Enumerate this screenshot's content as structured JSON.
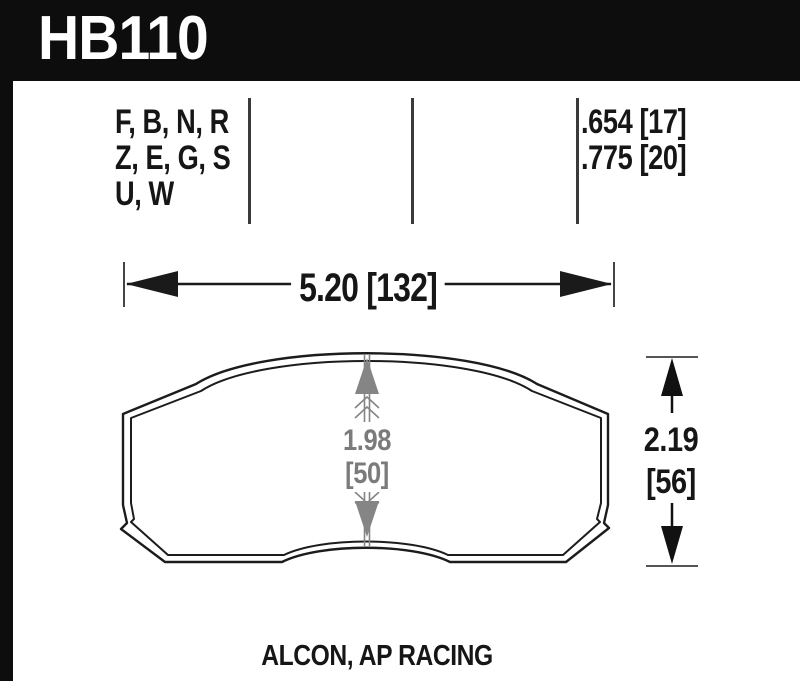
{
  "header": {
    "part_number": "HB110"
  },
  "compounds_column": {
    "lines": [
      "F, B, N, R",
      "Z, E, G, S",
      "U, W"
    ]
  },
  "thickness_column": {
    "lines": [
      ".654 [17]",
      ".775 [20]"
    ]
  },
  "dimensions": {
    "width": {
      "label": "5.20 [132]"
    },
    "pad_height_center": {
      "inches": "1.98",
      "millimeters": "[50]"
    },
    "overall_height": {
      "inches": "2.19",
      "millimeters": "[56]"
    }
  },
  "footer": {
    "applications": "ALCON, AP RACING"
  },
  "colors": {
    "header_bg": "#0d0d0d",
    "ink": "#161616",
    "dim_gray": "#7b7b7b",
    "outline": "#1c1c1c",
    "divider": "#3a3a3a"
  }
}
